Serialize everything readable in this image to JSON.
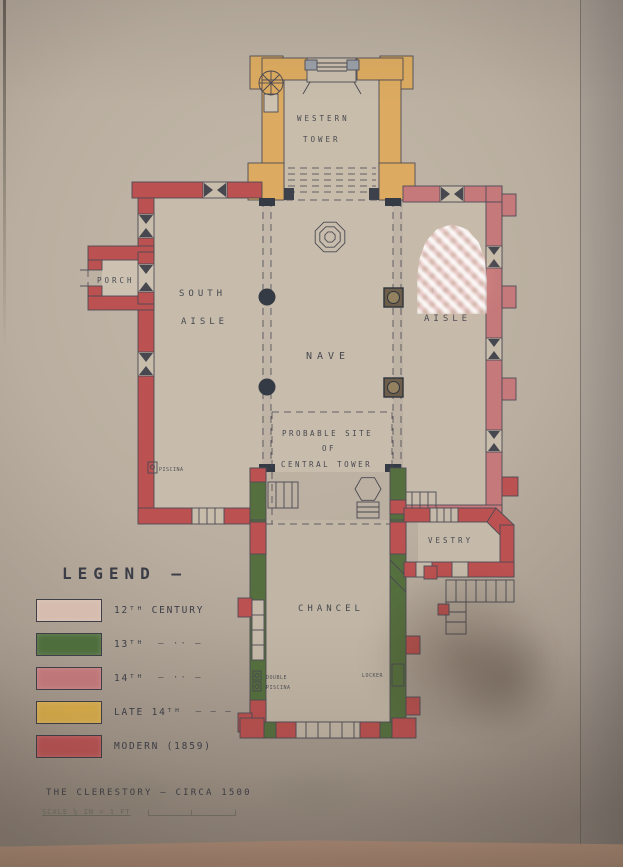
{
  "plan": {
    "labels": {
      "western_tower": [
        "WESTERN",
        "TOWER"
      ],
      "porch": "PORCH",
      "south_aisle": [
        "SOUTH",
        "AISLE"
      ],
      "nave": "NAVE",
      "north_aisle": [
        "NORTH",
        "AISLE"
      ],
      "central_tower": [
        "PROBABLE  SITE",
        "OF",
        "CENTRAL  TOWER"
      ],
      "chancel": "CHANCEL",
      "vestry": "VESTRY"
    },
    "annotations": {
      "piscina": "PISCINA",
      "double_piscina": [
        "DOUBLE",
        "PISCINA"
      ],
      "locker": "LOCKER"
    }
  },
  "legend": {
    "title": "LEGEND —",
    "items": [
      {
        "label": "12ᵀᴴ CENTURY",
        "ditto": "",
        "color": "#d5bcae"
      },
      {
        "label": "13ᵀᴴ",
        "ditto": "– ·· –",
        "color": "#4f6f3d"
      },
      {
        "label": "14ᵀᴴ",
        "ditto": "– ·· –",
        "color": "#c67a7c"
      },
      {
        "label": "LATE 14ᵀᴴ",
        "ditto": "– – –",
        "color": "#d9ad4a"
      },
      {
        "label": "MODERN (1859)",
        "ditto": "",
        "color": "#bd5355"
      }
    ]
  },
  "caption": {
    "title": "THE CLERESTORY — CIRCA 1500",
    "scale_note": "SCALE ⅛ IN = 1 FT"
  },
  "palette": {
    "paper": "#b9ae9f",
    "ink": "#3b3e48",
    "mount_board": "#ab8a75"
  }
}
